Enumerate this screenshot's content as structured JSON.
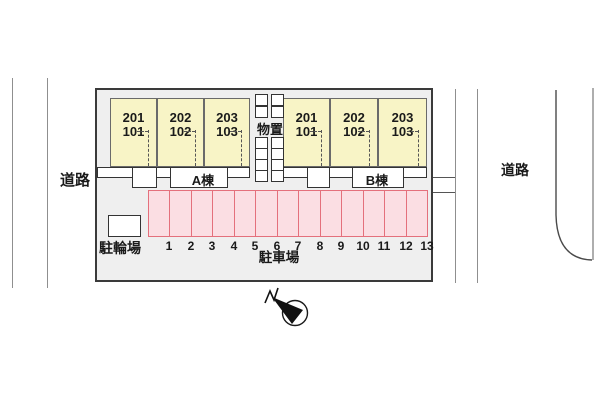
{
  "plan_title": "site-plan",
  "roads": {
    "left_label": "道路",
    "right_label": "道路"
  },
  "buildings": [
    {
      "name": "A棟",
      "rooms": [
        {
          "upper": "201",
          "lower": "101"
        },
        {
          "upper": "202",
          "lower": "102"
        },
        {
          "upper": "203",
          "lower": "103"
        }
      ]
    },
    {
      "name": "B棟",
      "rooms": [
        {
          "upper": "201",
          "lower": "101"
        },
        {
          "upper": "202",
          "lower": "102"
        },
        {
          "upper": "203",
          "lower": "103"
        }
      ]
    }
  ],
  "storage_label": "物置",
  "bicycle_label": "駐輪場",
  "parking": {
    "label": "駐車場",
    "spaces": [
      "1",
      "2",
      "3",
      "4",
      "5",
      "6",
      "7",
      "8",
      "9",
      "10",
      "11",
      "12",
      "13"
    ]
  },
  "colors": {
    "building_fill": "#f8f4c6",
    "parking_fill": "#fbdee3",
    "parking_border": "#e4707c",
    "site_fill": "#efefef",
    "outline": "#3a3a3a"
  }
}
